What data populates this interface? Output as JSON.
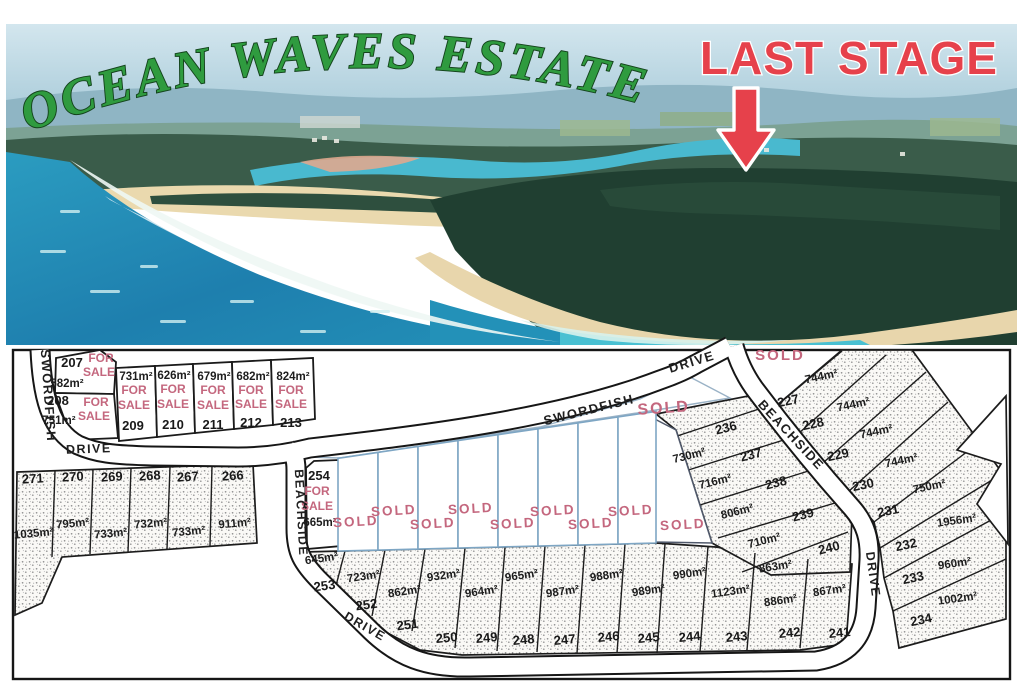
{
  "title": "OCEAN WAVES ESTATE",
  "stage_banner": "LAST STAGE",
  "status_labels": {
    "for_line1": "FOR",
    "for_line2": "SALE",
    "sold": "SOLD"
  },
  "colors": {
    "title_green": "#2f9b3f",
    "banner_red": "#e6414b",
    "sale_pink": "#c4677e",
    "road_line": "#151515",
    "sold_lot_outline": "#7ea6c4"
  },
  "streets": [
    {
      "id": "swordfish-west",
      "text": "SWORDFISH"
    },
    {
      "id": "drive-west",
      "text": "DRIVE"
    },
    {
      "id": "swordfish-main",
      "text": "SWORDFISH"
    },
    {
      "id": "drive-main",
      "text": "DRIVE"
    },
    {
      "id": "beachside-east",
      "text": "BEACHSIDE"
    },
    {
      "id": "beachside-west",
      "text": "BEACHSIDE"
    },
    {
      "id": "drive-east",
      "text": "DRIVE"
    },
    {
      "id": "drive-south",
      "text": "DRIVE"
    }
  ],
  "lots": [
    {
      "id": "207",
      "area": "582m²",
      "status": "for-sale"
    },
    {
      "id": "208",
      "area": "751m²",
      "status": "for-sale"
    },
    {
      "id": "209",
      "area": "731m²",
      "status": "for-sale"
    },
    {
      "id": "210",
      "area": "626m²",
      "status": "for-sale"
    },
    {
      "id": "211",
      "area": "679m²",
      "status": "for-sale"
    },
    {
      "id": "212",
      "area": "682m²",
      "status": "for-sale"
    },
    {
      "id": "213",
      "area": "824m²",
      "status": "for-sale"
    },
    {
      "id": "227",
      "area": "744m²",
      "status": "none"
    },
    {
      "id": "228",
      "area": "744m²",
      "status": "none"
    },
    {
      "id": "229",
      "area": "744m²",
      "status": "none"
    },
    {
      "id": "230",
      "area": "744m²",
      "status": "none"
    },
    {
      "id": "231",
      "area": "750m²",
      "status": "none"
    },
    {
      "id": "232",
      "area": "1956m²",
      "status": "none"
    },
    {
      "id": "233",
      "area": "960m²",
      "status": "none"
    },
    {
      "id": "234",
      "area": "1002m²",
      "status": "none"
    },
    {
      "id": "236",
      "area": "730m²",
      "status": "none"
    },
    {
      "id": "237",
      "area": "716m²",
      "status": "none"
    },
    {
      "id": "238",
      "area": "806m²",
      "status": "none"
    },
    {
      "id": "239",
      "area": "710m²",
      "status": "none"
    },
    {
      "id": "240",
      "area": "863m²",
      "status": "none"
    },
    {
      "id": "241",
      "area": "867m²",
      "status": "none"
    },
    {
      "id": "242",
      "area": "886m²",
      "status": "none"
    },
    {
      "id": "243",
      "area": "1123m²",
      "status": "none"
    },
    {
      "id": "244",
      "area": "990m²",
      "status": "none"
    },
    {
      "id": "245",
      "area": "989m²",
      "status": "none"
    },
    {
      "id": "246",
      "area": "988m²",
      "status": "none"
    },
    {
      "id": "247",
      "area": "987m²",
      "status": "none"
    },
    {
      "id": "248",
      "area": "965m²",
      "status": "none"
    },
    {
      "id": "249",
      "area": "964m²",
      "status": "none"
    },
    {
      "id": "250",
      "area": "932m²",
      "status": "none"
    },
    {
      "id": "251",
      "area": "862m²",
      "status": "none"
    },
    {
      "id": "252",
      "area": "723m²",
      "status": "none"
    },
    {
      "id": "253",
      "area": "645m²",
      "status": "none"
    },
    {
      "id": "254",
      "area": "665m²",
      "status": "for-sale"
    },
    {
      "id": "266",
      "area": "911m²",
      "status": "none"
    },
    {
      "id": "267",
      "area": "733m²",
      "status": "none"
    },
    {
      "id": "268",
      "area": "732m²",
      "status": "none"
    },
    {
      "id": "269",
      "area": "733m²",
      "status": "none"
    },
    {
      "id": "270",
      "area": "795m²",
      "status": "none"
    },
    {
      "id": "271",
      "area": "1035m²",
      "status": "none"
    }
  ],
  "sold_marks": [
    {
      "id": "sold-row-1"
    },
    {
      "id": "sold-row-2"
    },
    {
      "id": "sold-row-3"
    },
    {
      "id": "sold-row-4"
    },
    {
      "id": "sold-row-5"
    },
    {
      "id": "sold-row-6"
    },
    {
      "id": "sold-row-7"
    },
    {
      "id": "sold-row-8"
    },
    {
      "id": "sold-row-large"
    },
    {
      "id": "sold-central"
    },
    {
      "id": "sold-northeast"
    }
  ]
}
